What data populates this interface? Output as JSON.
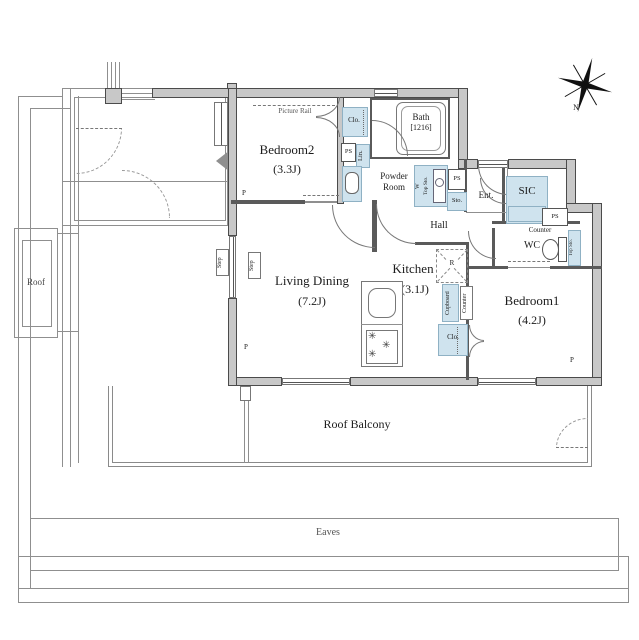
{
  "colors": {
    "wall_fill": "#c8c8c8",
    "wall_edge": "#4b4b4b",
    "fixture_fill": "#cfe3ee",
    "fixture_edge": "#8fb1c4",
    "thin_line": "#8f8f8f"
  },
  "rooms": {
    "bedroom2": {
      "name": "Bedroom2",
      "size": "(3.3J)"
    },
    "bedroom1": {
      "name": "Bedroom1",
      "size": "(4.2J)"
    },
    "living_dining": {
      "name": "Living Dining",
      "size": "(7.2J)"
    },
    "kitchen": {
      "name": "Kitchen",
      "size": "(3.1J)"
    },
    "bath": {
      "name": "Bath",
      "size": "[1216]"
    },
    "powder_room": {
      "line1": "Powder",
      "line2": "Room"
    },
    "wc": {
      "name": "WC"
    },
    "hall": {
      "name": "Hall"
    },
    "entrance": {
      "name": "Ent."
    },
    "sic": {
      "name": "SIC"
    }
  },
  "fixtures": {
    "closet": "Clo.",
    "linen": "Lin.",
    "storage": "Sto.",
    "top_storage": "Top Sto.",
    "washer": "W",
    "pipe_space": "PS",
    "cupboard": "Cupboard",
    "counter": "Counter",
    "refrigerator": "R",
    "picture_rail": "Picture Rail",
    "step": "Step",
    "pillar": "P"
  },
  "outdoor": {
    "roof": "Roof",
    "roof_balcony": "Roof Balcony",
    "eaves": "Eaves"
  },
  "compass": {
    "north": "N"
  }
}
